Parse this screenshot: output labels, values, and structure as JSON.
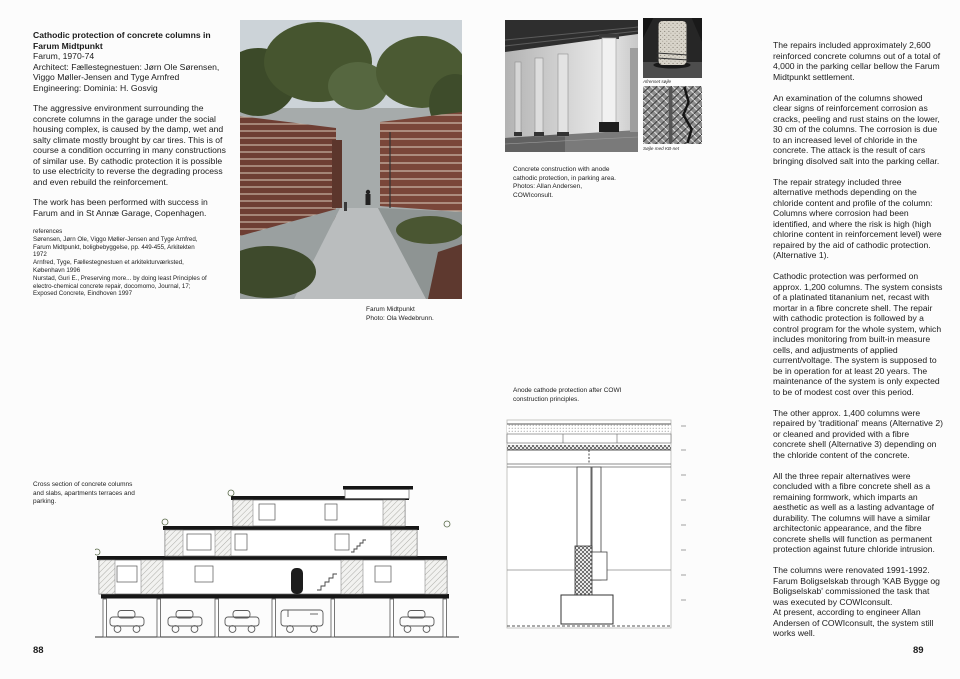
{
  "colors": {
    "page_bg": "#fcfcfc",
    "text": "#1c1c1c"
  },
  "left": {
    "page_number": "88",
    "title": "Cathodic protection of concrete columns in Farum Midtpunkt",
    "meta_lines": [
      "Farum, 1970-74",
      "Architect: Fællestegnestuen: Jørn Ole Sørensen, Viggo Møller-Jensen and Tyge Arnfred",
      "Engineering: Dominia: H. Gosvig"
    ],
    "paragraphs": [
      "The aggressive environment surrounding the concrete columns in the garage under the social housing complex, is caused by the damp, wet and salty climate mostly brought by car tires. This is of course a condition occurring in many constructions of similar use. By cathodic protection it is possible to use electricity to reverse the degrading process and even rebuild the reinforcement.",
      "The work has been performed with success in Farum and in St Annæ Garage, Copenhagen."
    ],
    "references_label": "references",
    "references": [
      "Sørensen, Jørn Ole, Viggo Møller-Jensen and Tyge Arnfred, Farum Midtpunkt, boligbebyggelse, pp. 449-455, Arkitekten 1972",
      "Arnfred, Tyge, Fællestegnestuen et arkitekturværksted, København 1996",
      "Nurstad, Guri E., Preserving more... by doing least Principles of electro-chemical concrete repair, docomomo, Journal, 17; Exposed Concrete, Eindhoven 1997"
    ],
    "photo_caption": "Farum Midtpunkt\nPhoto: Ola Wedebrunn.",
    "section_caption": "Cross section of concrete columns\nand slabs, apartments terraces and\nparking."
  },
  "right": {
    "page_number": "89",
    "photo_caption": "Concrete construction with anode\ncathodic protection, in parking area.\nPhotos: Allan Andersen,\nCOWIconsult.",
    "small_photo_captions": [
      "Afrenset søjle",
      "Søjle med KB-net"
    ],
    "diagram_caption": "Anode cathode protection after COWI\nconstruction principles.",
    "paragraphs": [
      "The repairs included approximately 2,600 reinforced concrete columns out of a total of 4,000 in the parking cellar bellow the Farum Midtpunkt settlement.",
      "An examination of the columns showed clear signs of reinforcement corrosion as cracks, peeling and rust stains on the lower, 30 cm of the columns. The corrosion is due to an increased level of chloride in the concrete. The attack is the result of cars bringing disolved salt into the parking cellar.",
      "The repair strategy included three alternative methods depending on the chloride content and profile of the column: Columns where corrosion had been identified, and where the risk is high (high chlorine content in reinforcement level) were repaired by the aid of cathodic protection. (Alternative 1).",
      "Cathodic protection was performed on approx. 1,200 columns. The system consists of a platinated titananium net, recast with mortar in a fibre concrete shell. The repair with cathodic protection is followed by a control program for the whole system, which includes monitoring from built-in measure cells, and adjustments of applied current/voltage. The system is supposed to be in operation for at least 20 years. The maintenance of the system is only expected to be of modest cost over this period.",
      "The other approx. 1,400 columns were repaired by 'traditional' means (Alternative 2) or cleaned and provided with a fibre concrete shell (Alternative 3) depending on the chloride content of the concrete.",
      "All the three repair alternatives were concluded with a fibre concrete shell as a remaining formwork, which imparts an aesthetic as well as a lasting advantage of durability. The columns will have a similar architectonic appearance, and the fibre concrete shells will function as permanent protection against future chloride intrusion.",
      "The columns were renovated 1991-1992. Farum Boligselskab through 'KAB Bygge og Boligselskab' commissioned the task that was executed by COWIconsult.\nAt present, according to engineer Allan Andersen of COWIconsult, the system still works well."
    ]
  }
}
